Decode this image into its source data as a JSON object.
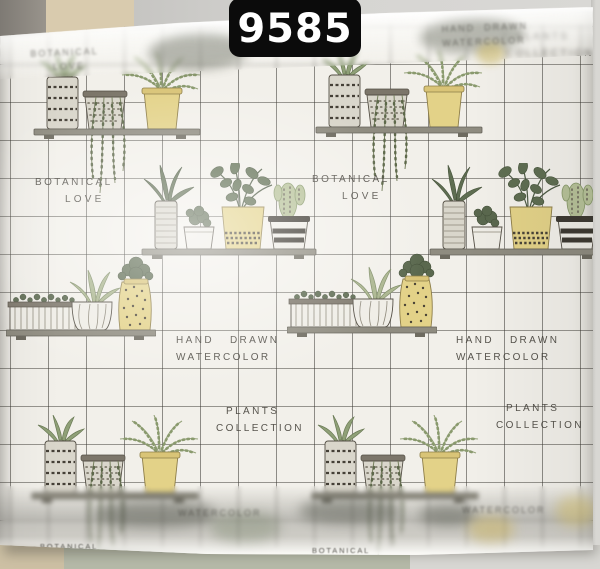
{
  "photo": {
    "subject": "Roll of frosted botanical-print self-adhesive film, partially unrolled against a wall",
    "code_badge": "9585"
  },
  "pattern_texts": {
    "botanical": "BOTANICAL",
    "love": "LOVE",
    "hand": "HAND",
    "drawn": "DRAWN",
    "watercolor": "WATERCOLOR",
    "plants": "PLANTS",
    "collection": "COLLECTION"
  },
  "motifs": {
    "shelf_trio": "striped pot with aloe, dotted pot with hanging vine, yellow pot with fern on a shelf",
    "shelf_quartet": "striped vase with leaves, succulent pot, yellow leafy-plant pot, striped cactus pot on a shelf",
    "planter_row": "ribbed planter box, scalloped agave pot, yellow dotted cactus vase on a shelf"
  },
  "colors": {
    "film_bg": "#f2f0ea",
    "grid_line": "#3a3832",
    "ink": "#413e37",
    "badge_bg": "#0b0b0b",
    "badge_text": "#ffffff",
    "pot_yellow": "#e3d288",
    "plant_green": "#8fa077",
    "plant_dark": "#5f6e52",
    "wall_beige": "#d9cbae",
    "wall_gray": "#cfcecb",
    "floor_beige": "#cdc0a4",
    "floor_sage": "#b5b9a8"
  }
}
